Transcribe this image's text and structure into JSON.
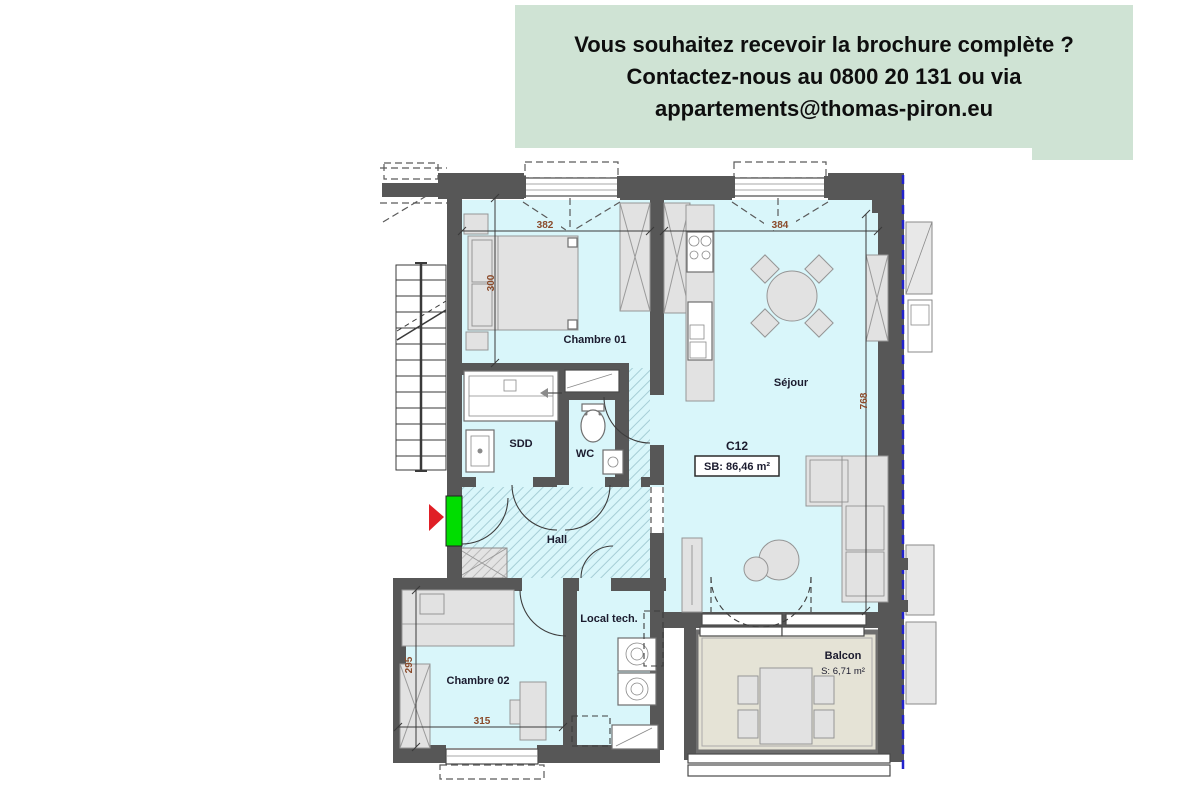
{
  "banner": {
    "line1": "Vous souhaitez recevoir la brochure complète ?",
    "line2": "Contactez-nous au 0800 20 131 ou via",
    "line3": "appartements@thomas-piron.eu"
  },
  "plan": {
    "rooms": {
      "chambre01": "Chambre 01",
      "sejour": "Séjour",
      "sdd": "SDD",
      "wc": "WC",
      "hall": "Hall",
      "chambre02": "Chambre 02",
      "local_tech": "Local tech.",
      "balcon": "Balcon"
    },
    "unit": {
      "code": "C12",
      "surface": "SB: 86,46 m²"
    },
    "balcony_surface": "S: 6,71 m²",
    "dimensions": {
      "chambre01_width": "382",
      "sejour_width": "384",
      "chambre01_height": "300",
      "sejour_height": "768",
      "chambre02_height": "295",
      "chambre02_width": "315"
    }
  },
  "colors": {
    "banner_bg": "#cfe3d4",
    "room_fill": "#d9f6fa",
    "wall": "#575757",
    "balcony_fill": "#e5e3d6",
    "entrance_green": "#00dd00",
    "arrow_red": "#e01f26",
    "dimension_text": "#8a4a2a",
    "label_text": "#1b1b2e",
    "property_line": "#2222cc"
  }
}
